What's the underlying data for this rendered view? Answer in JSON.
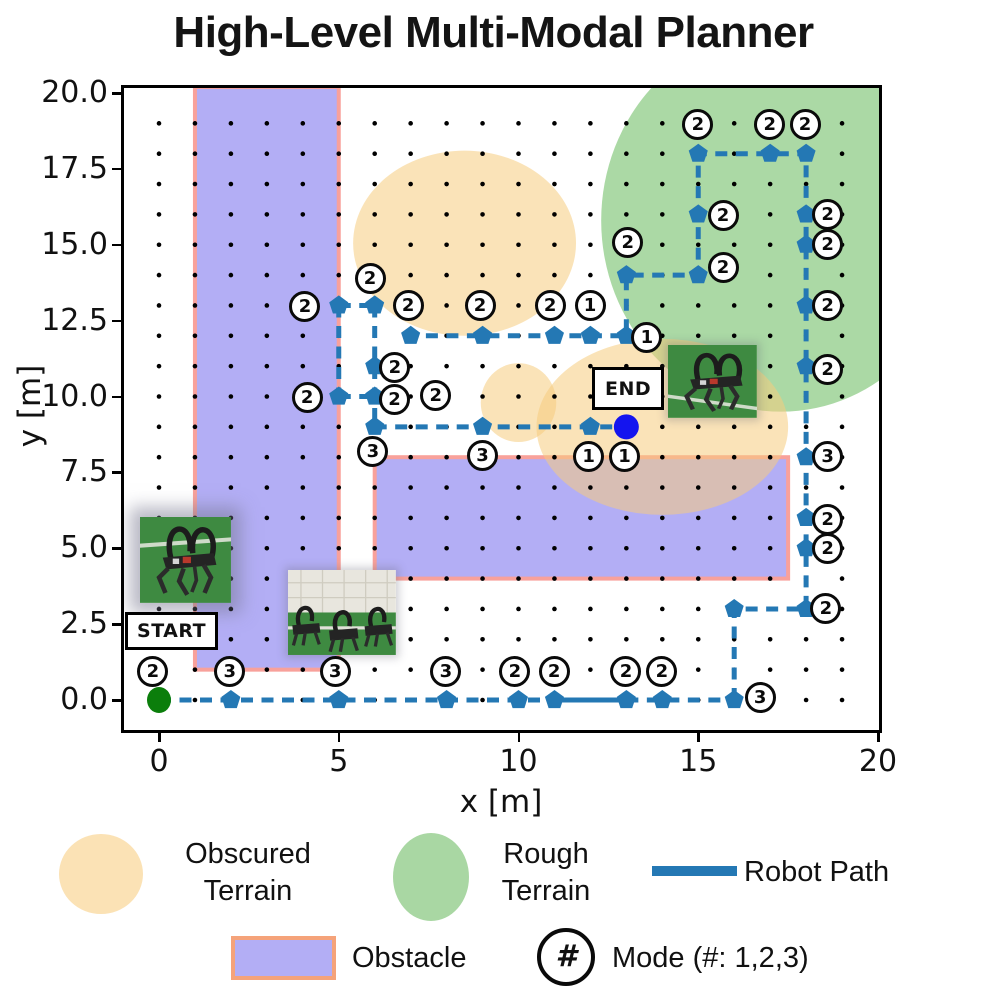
{
  "title": "High-Level Multi-Modal Planner",
  "axes": {
    "xlabel": "x [m]",
    "ylabel": "y [m]",
    "xticks": [
      {
        "label": "0",
        "value": 0
      },
      {
        "label": "5",
        "value": 5
      },
      {
        "label": "10",
        "value": 10
      },
      {
        "label": "15",
        "value": 15
      },
      {
        "label": "20",
        "value": 20
      }
    ],
    "yticks": [
      {
        "label": "0.0",
        "value": 0
      },
      {
        "label": "2.5",
        "value": 2.5
      },
      {
        "label": "5.0",
        "value": 5
      },
      {
        "label": "7.5",
        "value": 7.5
      },
      {
        "label": "10.0",
        "value": 10
      },
      {
        "label": "12.5",
        "value": 12.5
      },
      {
        "label": "15.0",
        "value": 15
      },
      {
        "label": "17.5",
        "value": 17.5
      },
      {
        "label": "20.0",
        "value": 20
      }
    ],
    "xlim": [
      -0.97,
      20.17
    ],
    "ylim": [
      -0.97,
      20.17
    ]
  },
  "chart_data": {
    "type": "path-plan-map",
    "grid_dots": {
      "x_min": 0,
      "x_max": 19,
      "y_min": 0,
      "y_max": 19,
      "step": 1
    },
    "obstacles": [
      {
        "x": 1,
        "y": 1,
        "w": 4,
        "h": 19.2
      },
      {
        "x": 6,
        "y": 4,
        "w": 11.5,
        "h": 4
      }
    ],
    "terrain_obscured": [
      {
        "cx": 8.5,
        "cy": 15.05,
        "rx": 3.1,
        "ry": 3.05
      },
      {
        "cx": 14.0,
        "cy": 9.0,
        "rx": 3.5,
        "ry": 2.9
      },
      {
        "cx": 10.0,
        "cy": 9.8,
        "rx": 1.05,
        "ry": 1.3
      }
    ],
    "terrain_rough": [
      {
        "cx": 17.3,
        "cy": 15.8,
        "rx": 5.0,
        "ry": 6.3
      }
    ],
    "path_dashed": [
      [
        [
          0,
          0
        ],
        [
          11,
          0
        ]
      ],
      [
        [
          13,
          0
        ],
        [
          16,
          0
        ]
      ],
      [
        [
          16,
          0
        ],
        [
          16,
          3
        ],
        [
          18,
          3
        ],
        [
          18,
          18
        ],
        [
          15,
          18
        ],
        [
          15,
          14
        ],
        [
          13,
          14
        ],
        [
          13,
          12
        ],
        [
          7,
          12
        ]
      ],
      [
        [
          6,
          13
        ],
        [
          6,
          9
        ]
      ],
      [
        [
          5,
          13
        ],
        [
          6,
          13
        ]
      ],
      [
        [
          5,
          13
        ],
        [
          5,
          10
        ]
      ],
      [
        [
          5,
          10
        ],
        [
          6,
          10
        ]
      ],
      [
        [
          6,
          9
        ],
        [
          13,
          9
        ]
      ]
    ],
    "path_solid": [
      [
        [
          11,
          0
        ],
        [
          13,
          0
        ]
      ]
    ],
    "markers": [
      [
        2,
        0
      ],
      [
        5,
        0
      ],
      [
        8,
        0
      ],
      [
        10,
        0
      ],
      [
        11,
        0
      ],
      [
        13,
        0
      ],
      [
        14,
        0
      ],
      [
        16,
        0
      ],
      [
        16,
        3
      ],
      [
        18,
        3
      ],
      [
        18,
        5
      ],
      [
        18,
        6
      ],
      [
        18,
        8
      ],
      [
        18,
        11
      ],
      [
        18,
        13
      ],
      [
        18,
        15
      ],
      [
        18,
        16
      ],
      [
        18,
        18
      ],
      [
        17,
        18
      ],
      [
        15,
        18
      ],
      [
        15,
        16
      ],
      [
        15,
        14
      ],
      [
        13,
        14
      ],
      [
        13,
        12
      ],
      [
        12,
        12
      ],
      [
        11,
        12
      ],
      [
        9,
        12
      ],
      [
        7,
        12
      ],
      [
        6,
        13
      ],
      [
        5,
        13
      ],
      [
        6,
        11
      ],
      [
        6,
        10
      ],
      [
        5,
        10
      ],
      [
        6,
        9
      ],
      [
        9,
        9
      ],
      [
        12,
        9
      ]
    ],
    "modes": [
      {
        "n": 2,
        "x": -0.17,
        "y": 0.93
      },
      {
        "n": 3,
        "x": 1.97,
        "y": 0.93
      },
      {
        "n": 3,
        "x": 4.9,
        "y": 0.93
      },
      {
        "n": 3,
        "x": 7.98,
        "y": 0.93
      },
      {
        "n": 2,
        "x": 9.9,
        "y": 0.95
      },
      {
        "n": 2,
        "x": 10.99,
        "y": 0.95
      },
      {
        "n": 2,
        "x": 12.99,
        "y": 0.95
      },
      {
        "n": 2,
        "x": 13.99,
        "y": 0.95
      },
      {
        "n": 3,
        "x": 16.72,
        "y": 0.07
      },
      {
        "n": 2,
        "x": 18.55,
        "y": 3.02
      },
      {
        "n": 2,
        "x": 18.6,
        "y": 5.0
      },
      {
        "n": 2,
        "x": 18.6,
        "y": 5.95
      },
      {
        "n": 3,
        "x": 18.6,
        "y": 8.03
      },
      {
        "n": 2,
        "x": 18.6,
        "y": 10.9
      },
      {
        "n": 2,
        "x": 18.6,
        "y": 13.0
      },
      {
        "n": 2,
        "x": 18.6,
        "y": 15.0
      },
      {
        "n": 2,
        "x": 18.6,
        "y": 16.0
      },
      {
        "n": 2,
        "x": 17.97,
        "y": 18.95
      },
      {
        "n": 2,
        "x": 16.99,
        "y": 18.95
      },
      {
        "n": 2,
        "x": 14.99,
        "y": 18.95
      },
      {
        "n": 2,
        "x": 15.69,
        "y": 15.98
      },
      {
        "n": 2,
        "x": 15.69,
        "y": 14.24
      },
      {
        "n": 2,
        "x": 13.04,
        "y": 15.07
      },
      {
        "n": 1,
        "x": 11.99,
        "y": 13.0
      },
      {
        "n": 2,
        "x": 10.88,
        "y": 13.0
      },
      {
        "n": 2,
        "x": 8.93,
        "y": 13.0
      },
      {
        "n": 2,
        "x": 6.93,
        "y": 13.0
      },
      {
        "n": 1,
        "x": 13.57,
        "y": 11.96
      },
      {
        "n": 2,
        "x": 5.87,
        "y": 13.88
      },
      {
        "n": 2,
        "x": 4.06,
        "y": 12.95
      },
      {
        "n": 2,
        "x": 6.56,
        "y": 10.94
      },
      {
        "n": 2,
        "x": 4.12,
        "y": 9.98
      },
      {
        "n": 2,
        "x": 6.55,
        "y": 9.9
      },
      {
        "n": 2,
        "x": 7.7,
        "y": 10.02
      },
      {
        "n": 3,
        "x": 5.95,
        "y": 8.18
      },
      {
        "n": 3,
        "x": 9.0,
        "y": 8.05
      },
      {
        "n": 1,
        "x": 11.95,
        "y": 8.03
      },
      {
        "n": 1,
        "x": 12.95,
        "y": 8.03
      }
    ],
    "start": {
      "x": 0,
      "y": 0,
      "label": "START",
      "box": {
        "x": -0.95,
        "y_top": 2.91,
        "w": 2.6,
        "h": 1.26
      }
    },
    "end": {
      "x": 13,
      "y": 9,
      "label": "END",
      "box": {
        "x": 12.05,
        "y_top": 10.97,
        "w": 2.0,
        "h": 1.42
      }
    },
    "images": [
      {
        "name": "robot-photo-start",
        "variant": "single-a",
        "x": -0.53,
        "y_top": 6.03,
        "w": 2.53,
        "h": 2.83,
        "glow": true
      },
      {
        "name": "robot-photo-mid",
        "variant": "trio",
        "x": 3.59,
        "y_top": 4.28,
        "w": 3.0,
        "h": 2.8,
        "glow": false
      },
      {
        "name": "robot-photo-end",
        "variant": "single-b",
        "x": 14.16,
        "y_top": 11.7,
        "w": 2.47,
        "h": 2.4,
        "glow": false
      }
    ]
  },
  "legend": {
    "obscured_lines": [
      "Obscured",
      "Terrain"
    ],
    "rough_lines": [
      "Rough",
      "Terrain"
    ],
    "path_label": "Robot Path",
    "obstacle_label": "Obstacle",
    "mode_symbol": "#",
    "mode_label": "Mode (#: 1,2,3)"
  },
  "colors": {
    "path_blue": "#2478B4",
    "obstacle_fill": "rgba(103,93,235,0.5)",
    "obstacle_edge": "#F8A19B",
    "obscured_fill": "rgba(246,204,126,0.55)",
    "rough_fill": "rgba(87,179,75,0.5)",
    "grid_dot": "#000000",
    "start_green": "#0B7E0B",
    "end_blue": "#1414EF",
    "legend_obscured": "#FBE2B5",
    "legend_rough": "#A9D7A3",
    "legend_obstacle_fill": "#B3AEF5",
    "legend_obstacle_edge": "#F5A37A"
  }
}
